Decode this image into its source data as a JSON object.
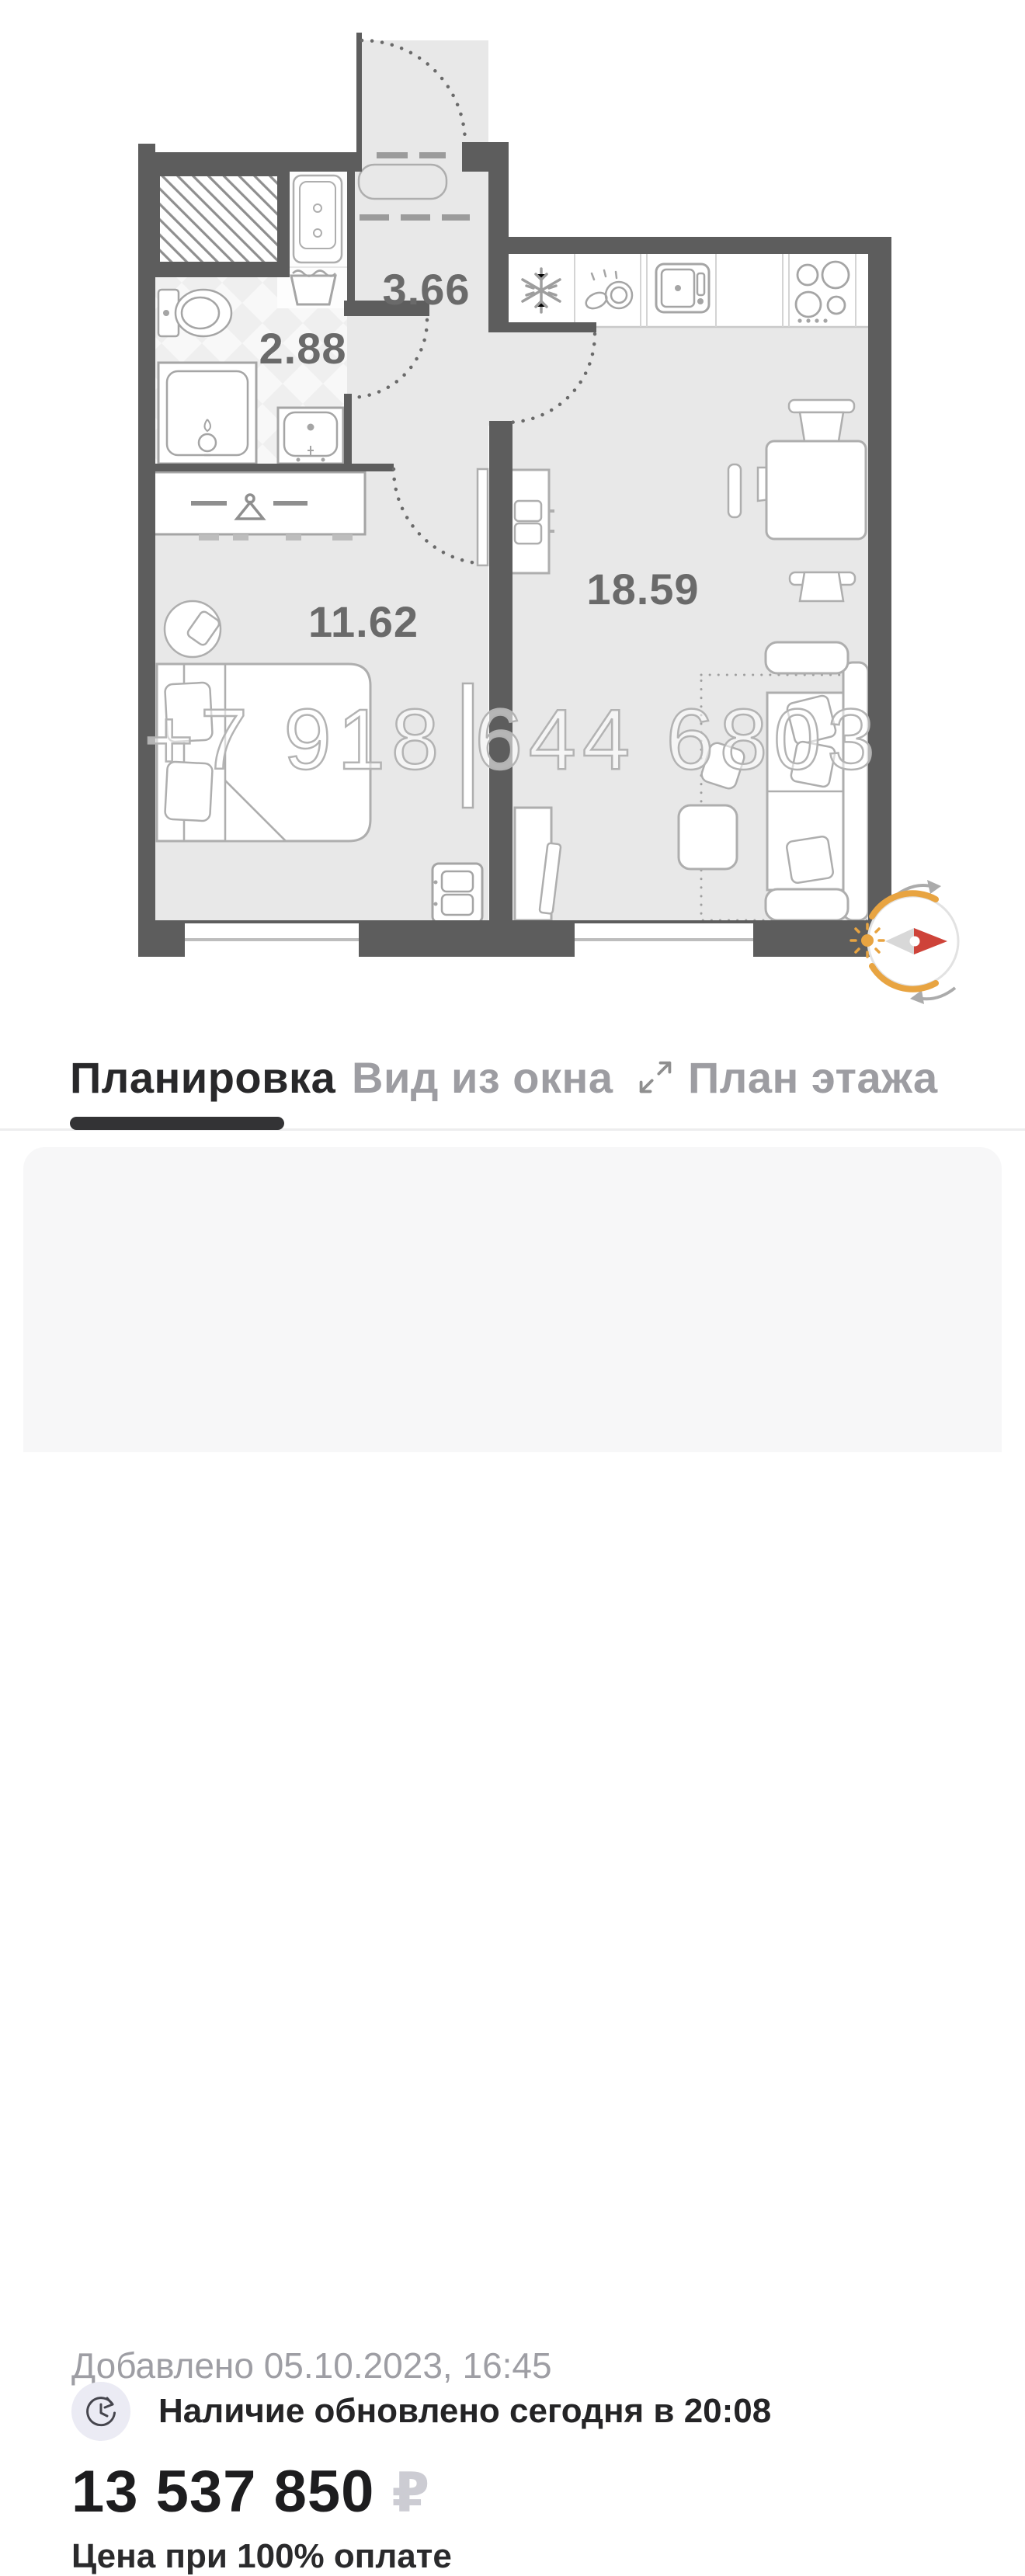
{
  "floor_plan": {
    "rooms": [
      {
        "id": "hallway",
        "area": "3.66"
      },
      {
        "id": "bathroom",
        "area": "2.88"
      },
      {
        "id": "bedroom",
        "area": "11.62"
      },
      {
        "id": "living-kitchen",
        "area": "18.59"
      }
    ],
    "watermark": "+7 918 644 6803",
    "icons": [
      "snowflake-fridge-icon",
      "dishes-icon",
      "sink-icon",
      "stove-icon",
      "hanger-icon",
      "toilet-icon",
      "shower-icon",
      "bathtub-icon",
      "sun-icon",
      "compass-needle-icon"
    ],
    "colors": {
      "wall": "#5d5d5d",
      "floor": "#e8e8e8",
      "accent_orange": "#e8a441",
      "accent_red": "#ce4339",
      "furniture_stroke": "#aeaeae"
    }
  },
  "tabs": [
    {
      "label": "Планировка",
      "active": true
    },
    {
      "label": "Вид из окна",
      "active": false
    },
    {
      "label": "План этажа",
      "active": false,
      "icon": "expand-icon"
    }
  ],
  "card": {
    "added": "Добавлено 05.10.2023, 16:45",
    "availability": "Наличие обновлено сегодня в 20:08",
    "price": "13 537 850",
    "currency": "₽",
    "price_note": "Цена при 100% оплате"
  }
}
